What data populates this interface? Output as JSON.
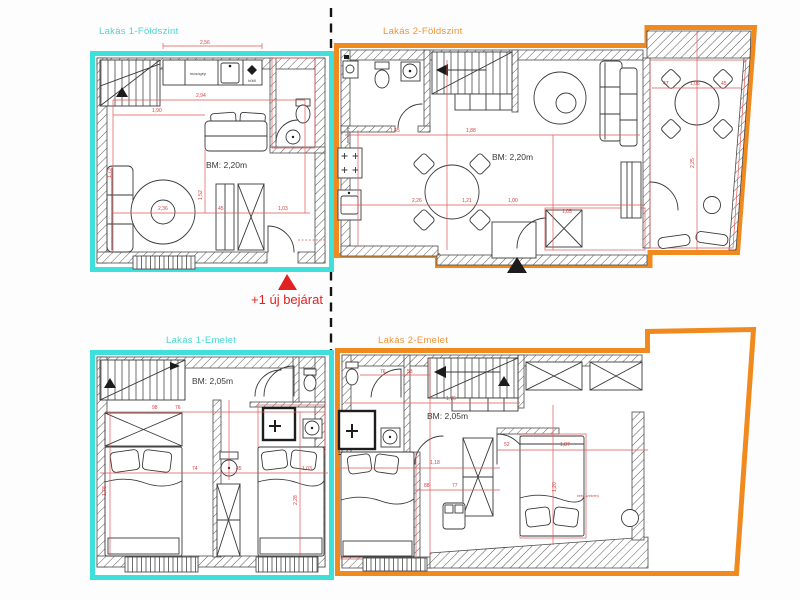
{
  "meta": {
    "type": "architectural-floorplan",
    "units_note": "BM = belmagasság (ceiling height)"
  },
  "colors": {
    "apartment1_accent": "#3fe0db",
    "apartment2_accent": "#f0891e",
    "annotation_red": "#e02222",
    "dimension_red": "#d83d3d"
  },
  "panels": {
    "p1": {
      "title": "Lakás 1-Földszint",
      "bm": "BM: 2,20m"
    },
    "p2": {
      "title": "Lakás 2-Földszint",
      "bm": "BM: 2,20m"
    },
    "p3": {
      "title": "Lakás 1-Emelet",
      "bm": "BM: 2,05m"
    },
    "p4": {
      "title": "Lakás 2-Emelet",
      "bm": "BM: 2,05m"
    }
  },
  "annotation": {
    "new_entrance": "+1 új bejárat"
  },
  "appliance_labels": {
    "washer": "mosógép",
    "fridge": "hűtő",
    "closet": "beép.szekrény"
  },
  "dims": [
    {
      "t": "2,56",
      "x": 200,
      "y": 44
    },
    {
      "t": "2,94",
      "x": 196,
      "y": 97
    },
    {
      "t": "1,90",
      "x": 152,
      "y": 112
    },
    {
      "t": "2,36",
      "x": 158,
      "y": 210
    },
    {
      "t": "45",
      "x": 218,
      "y": 210
    },
    {
      "t": "1,03",
      "x": 278,
      "y": 210
    },
    {
      "t": "1,73",
      "x": 111,
      "y": 178,
      "r": -90
    },
    {
      "t": "1,52",
      "x": 202,
      "y": 200,
      "r": -90
    },
    {
      "t": "1,45",
      "x": 390,
      "y": 132
    },
    {
      "t": "1,88",
      "x": 466,
      "y": 132
    },
    {
      "t": "2,26",
      "x": 412,
      "y": 202
    },
    {
      "t": "1,21",
      "x": 462,
      "y": 202
    },
    {
      "t": "1,00",
      "x": 508,
      "y": 202
    },
    {
      "t": "1,05",
      "x": 562,
      "y": 213
    },
    {
      "t": "2,25",
      "x": 694,
      "y": 168,
      "r": -90
    },
    {
      "t": "47",
      "x": 663,
      "y": 85
    },
    {
      "t": "1,06",
      "x": 690,
      "y": 85
    },
    {
      "t": "45",
      "x": 721,
      "y": 85
    },
    {
      "t": "98",
      "x": 152,
      "y": 409
    },
    {
      "t": "76",
      "x": 175,
      "y": 409
    },
    {
      "t": "74",
      "x": 192,
      "y": 470
    },
    {
      "t": "45",
      "x": 236,
      "y": 470
    },
    {
      "t": "1,03",
      "x": 302,
      "y": 470
    },
    {
      "t": "1,78",
      "x": 106,
      "y": 496,
      "r": -90
    },
    {
      "t": "2,28",
      "x": 297,
      "y": 505,
      "r": -90
    },
    {
      "t": "76",
      "x": 380,
      "y": 373
    },
    {
      "t": "58",
      "x": 407,
      "y": 373
    },
    {
      "t": "1,76",
      "x": 446,
      "y": 400
    },
    {
      "t": "1,18",
      "x": 430,
      "y": 464
    },
    {
      "t": "88",
      "x": 424,
      "y": 487
    },
    {
      "t": "77",
      "x": 452,
      "y": 487
    },
    {
      "t": "52",
      "x": 504,
      "y": 446
    },
    {
      "t": "1,87",
      "x": 560,
      "y": 446
    },
    {
      "t": "1,20",
      "x": 556,
      "y": 492,
      "r": -90
    }
  ]
}
